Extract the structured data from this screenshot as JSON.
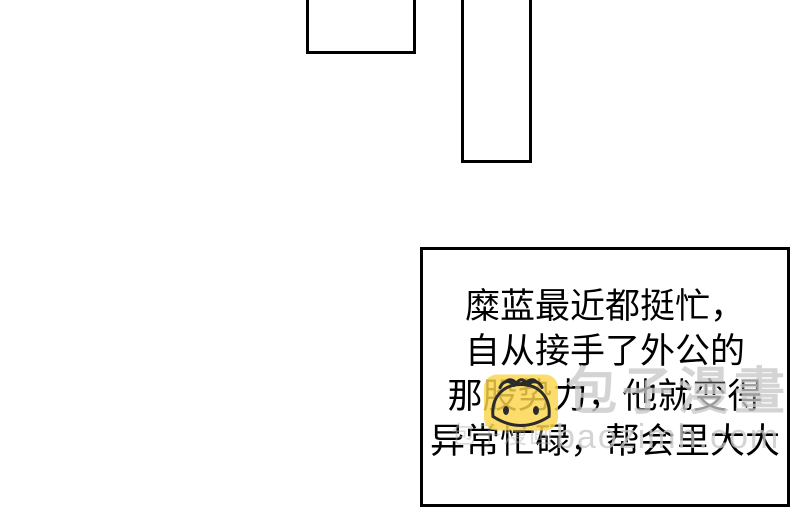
{
  "canvas": {
    "width": 800,
    "height": 474,
    "background_color": "#ffffff",
    "panel_border_color": "#000000"
  },
  "speech_box": {
    "lines": [
      "糜蓝最近都挺忙，",
      "自从接手了外公的",
      "那股势力，他就变得",
      "异常忙碌，帮会里大大"
    ],
    "text_color": "#000000"
  },
  "watermark": {
    "site_name": "包子漫畫",
    "site_url": "baozimh.com",
    "faint_fragment": "包子漫画",
    "color": "#c8c8c8"
  },
  "mascot": {
    "name": "baozi bun mascot",
    "badge_color": "#fbd44b",
    "outline_color": "#2b2b2b"
  }
}
